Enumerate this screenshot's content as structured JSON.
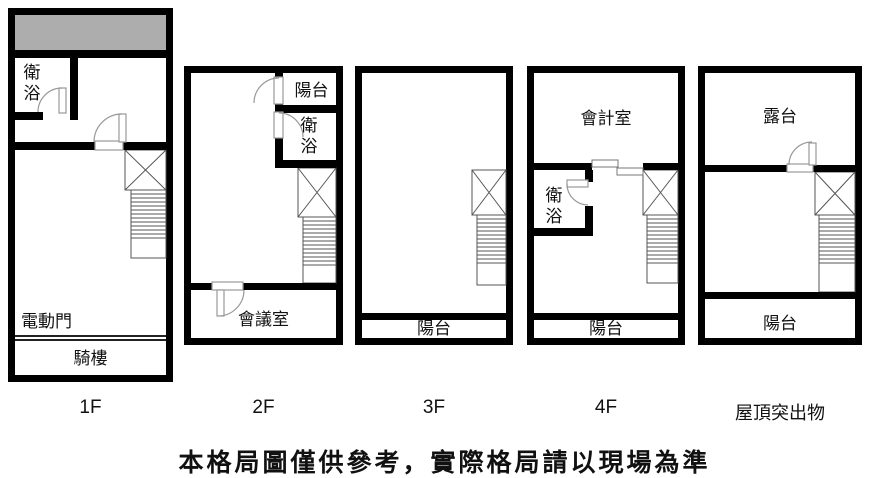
{
  "title": "floor-plan-diagram",
  "colors": {
    "wall": "#000000",
    "gray_area": "#adadad",
    "background": "#ffffff",
    "thin_line": "#555555",
    "door_arc": "#999999"
  },
  "disclaimer": "本格局圖僅供參考，實際格局請以現場為準",
  "floors": [
    {
      "id": "1f",
      "label": "1F",
      "rooms": {
        "bath": "衛浴",
        "electric_door": "電動門",
        "arcade": "騎樓"
      }
    },
    {
      "id": "2f",
      "label": "2F",
      "rooms": {
        "balcony": "陽台",
        "bath": "衛浴",
        "meeting": "會議室"
      }
    },
    {
      "id": "3f",
      "label": "3F",
      "rooms": {
        "balcony": "陽台"
      }
    },
    {
      "id": "4f",
      "label": "4F",
      "rooms": {
        "accounting": "會計室",
        "bath": "衛浴",
        "balcony": "陽台"
      }
    },
    {
      "id": "roof",
      "label": "屋頂突出物",
      "rooms": {
        "terrace": "露台",
        "balcony": "陽台"
      }
    }
  ]
}
